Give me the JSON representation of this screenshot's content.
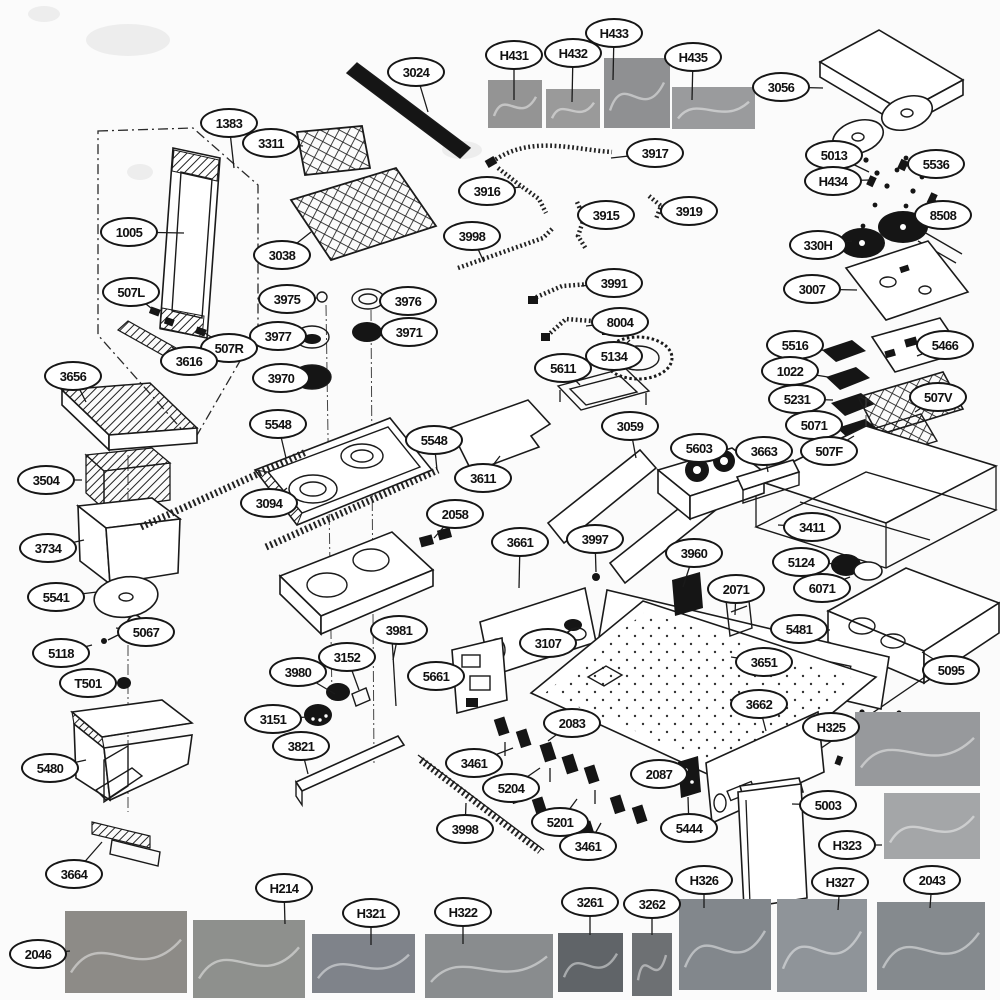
{
  "diagram": {
    "description": "Appliance exploded-parts diagram (gas range) with numbered callout labels and part photos",
    "ink_color": "#161616",
    "background_color": "#fbfbfb",
    "labels": [
      {
        "t": "3024",
        "x": 416,
        "y": 72,
        "tx": 428,
        "ty": 112
      },
      {
        "t": "H431",
        "x": 514,
        "y": 55,
        "tx": 514,
        "ty": 100
      },
      {
        "t": "H432",
        "x": 573,
        "y": 53,
        "tx": 572,
        "ty": 102
      },
      {
        "t": "H433",
        "x": 614,
        "y": 33,
        "tx": 613,
        "ty": 80
      },
      {
        "t": "H435",
        "x": 693,
        "y": 57,
        "tx": 692,
        "ty": 100
      },
      {
        "t": "3056",
        "x": 781,
        "y": 87,
        "tx": 823,
        "ty": 88
      },
      {
        "t": "1383",
        "x": 229,
        "y": 123,
        "tx": 234,
        "ty": 168
      },
      {
        "t": "3311",
        "x": 271,
        "y": 143,
        "tx": 303,
        "ty": 146
      },
      {
        "t": "3917",
        "x": 655,
        "y": 153,
        "tx": 611,
        "ty": 158
      },
      {
        "t": "5013",
        "x": 834,
        "y": 155,
        "tx": 869,
        "ty": 172
      },
      {
        "t": "H434",
        "x": 833,
        "y": 181,
        "tx": 870,
        "ty": 180
      },
      {
        "t": "5536",
        "x": 936,
        "y": 164,
        "tx": 906,
        "ty": 166
      },
      {
        "t": "3916",
        "x": 487,
        "y": 191,
        "tx": 521,
        "ty": 187
      },
      {
        "t": "3915",
        "x": 606,
        "y": 215,
        "tx": 580,
        "ty": 207
      },
      {
        "t": "3919",
        "x": 689,
        "y": 211,
        "tx": 661,
        "ty": 206
      },
      {
        "t": "8508",
        "x": 943,
        "y": 215,
        "tx": 933,
        "ty": 196
      },
      {
        "t": "1005",
        "x": 129,
        "y": 232,
        "tx": 184,
        "ty": 233
      },
      {
        "t": "3038",
        "x": 282,
        "y": 255,
        "tx": 311,
        "ty": 232
      },
      {
        "t": "3998",
        "x": 472,
        "y": 236,
        "tx": 484,
        "ty": 262
      },
      {
        "t": "330H",
        "x": 818,
        "y": 245,
        "tx": 852,
        "ty": 241
      },
      {
        "t": "3007",
        "x": 812,
        "y": 289,
        "tx": 857,
        "ty": 290
      },
      {
        "t": "3991",
        "x": 614,
        "y": 283,
        "tx": 581,
        "ty": 286
      },
      {
        "t": "507L",
        "x": 131,
        "y": 292,
        "tx": 156,
        "ty": 312
      },
      {
        "t": "3975",
        "x": 287,
        "y": 299,
        "tx": 317,
        "ty": 298
      },
      {
        "t": "3976",
        "x": 408,
        "y": 301,
        "tx": 384,
        "ty": 300
      },
      {
        "t": "8004",
        "x": 620,
        "y": 322,
        "tx": 586,
        "ty": 326
      },
      {
        "t": "3977",
        "x": 278,
        "y": 336,
        "tx": 300,
        "ty": 337
      },
      {
        "t": "3971",
        "x": 409,
        "y": 332,
        "tx": 382,
        "ty": 332
      },
      {
        "t": "507R",
        "x": 229,
        "y": 348,
        "tx": 203,
        "ty": 332
      },
      {
        "t": "3616",
        "x": 189,
        "y": 361,
        "tx": 172,
        "ty": 347
      },
      {
        "t": "5134",
        "x": 614,
        "y": 356,
        "tx": 630,
        "ty": 340
      },
      {
        "t": "5611",
        "x": 563,
        "y": 368,
        "tx": 580,
        "ty": 385
      },
      {
        "t": "5516",
        "x": 795,
        "y": 345,
        "tx": 827,
        "ty": 351
      },
      {
        "t": "5466",
        "x": 945,
        "y": 345,
        "tx": 917,
        "ty": 356
      },
      {
        "t": "3970",
        "x": 281,
        "y": 378,
        "tx": 296,
        "ty": 377
      },
      {
        "t": "1022",
        "x": 790,
        "y": 371,
        "tx": 828,
        "ty": 377
      },
      {
        "t": "3656",
        "x": 73,
        "y": 376,
        "tx": 86,
        "ty": 402
      },
      {
        "t": "5231",
        "x": 797,
        "y": 399,
        "tx": 833,
        "ty": 400
      },
      {
        "t": "507V",
        "x": 938,
        "y": 397,
        "tx": 915,
        "ty": 412
      },
      {
        "t": "5548",
        "x": 278,
        "y": 424,
        "tx": 286,
        "ty": 458
      },
      {
        "t": "5071",
        "x": 814,
        "y": 425,
        "tx": 840,
        "ty": 420
      },
      {
        "t": "5548",
        "x": 434,
        "y": 440,
        "tx": 437,
        "ty": 470
      },
      {
        "t": "3059",
        "x": 630,
        "y": 426,
        "tx": 636,
        "ty": 458
      },
      {
        "t": "507F",
        "x": 829,
        "y": 451,
        "tx": 854,
        "ty": 436
      },
      {
        "t": "3611",
        "x": 483,
        "y": 478,
        "tx": 500,
        "ty": 456
      },
      {
        "t": "5603",
        "x": 699,
        "y": 448,
        "tx": 708,
        "ty": 470
      },
      {
        "t": "3663",
        "x": 764,
        "y": 451,
        "tx": 768,
        "ty": 472
      },
      {
        "t": "3504",
        "x": 46,
        "y": 480,
        "tx": 82,
        "ty": 480
      },
      {
        "t": "3094",
        "x": 269,
        "y": 503,
        "tx": 287,
        "ty": 488
      },
      {
        "t": "3411",
        "x": 812,
        "y": 527,
        "tx": 778,
        "ty": 525
      },
      {
        "t": "3734",
        "x": 48,
        "y": 548,
        "tx": 84,
        "ty": 540
      },
      {
        "t": "2058",
        "x": 455,
        "y": 514,
        "tx": 434,
        "ty": 538
      },
      {
        "t": "3661",
        "x": 520,
        "y": 542,
        "tx": 519,
        "ty": 588
      },
      {
        "t": "3997",
        "x": 595,
        "y": 539,
        "tx": 596,
        "ty": 572
      },
      {
        "t": "3960",
        "x": 694,
        "y": 553,
        "tx": 683,
        "ty": 587
      },
      {
        "t": "5124",
        "x": 801,
        "y": 562,
        "tx": 838,
        "ty": 564
      },
      {
        "t": "2071",
        "x": 736,
        "y": 589,
        "tx": 735,
        "ty": 615
      },
      {
        "t": "6071",
        "x": 822,
        "y": 588,
        "tx": 850,
        "ty": 577
      },
      {
        "t": "5541",
        "x": 56,
        "y": 597,
        "tx": 97,
        "ty": 592
      },
      {
        "t": "5481",
        "x": 799,
        "y": 629,
        "tx": 830,
        "ty": 630
      },
      {
        "t": "5067",
        "x": 146,
        "y": 632,
        "tx": 116,
        "ty": 628
      },
      {
        "t": "3107",
        "x": 548,
        "y": 643,
        "tx": 573,
        "ty": 629
      },
      {
        "t": "5118",
        "x": 61,
        "y": 653,
        "tx": 92,
        "ty": 645
      },
      {
        "t": "3651",
        "x": 764,
        "y": 662,
        "tx": 731,
        "ty": 657
      },
      {
        "t": "5095",
        "x": 951,
        "y": 670,
        "tx": 922,
        "ty": 652
      },
      {
        "t": "T501",
        "x": 88,
        "y": 683,
        "tx": 120,
        "ty": 683
      },
      {
        "t": "3981",
        "x": 399,
        "y": 630,
        "tx": 393,
        "ty": 660
      },
      {
        "t": "3152",
        "x": 347,
        "y": 657,
        "tx": 359,
        "ty": 690
      },
      {
        "t": "3980",
        "x": 298,
        "y": 672,
        "tx": 335,
        "ty": 694
      },
      {
        "t": "5661",
        "x": 436,
        "y": 676,
        "tx": 461,
        "ty": 679
      },
      {
        "t": "2083",
        "x": 572,
        "y": 723,
        "tx": 548,
        "ty": 741
      },
      {
        "t": "3151",
        "x": 273,
        "y": 719,
        "tx": 308,
        "ty": 717
      },
      {
        "t": "3662",
        "x": 759,
        "y": 704,
        "tx": 766,
        "ty": 731
      },
      {
        "t": "H325",
        "x": 831,
        "y": 727,
        "tx": 860,
        "ty": 727
      },
      {
        "t": "3821",
        "x": 301,
        "y": 746,
        "tx": 308,
        "ty": 774
      },
      {
        "t": "5480",
        "x": 50,
        "y": 768,
        "tx": 86,
        "ty": 760
      },
      {
        "t": "3461",
        "x": 474,
        "y": 763,
        "tx": 513,
        "ty": 748
      },
      {
        "t": "5204",
        "x": 511,
        "y": 788,
        "tx": 540,
        "ty": 768
      },
      {
        "t": "2087",
        "x": 659,
        "y": 774,
        "tx": 680,
        "ty": 776
      },
      {
        "t": "5444",
        "x": 689,
        "y": 828,
        "tx": 688,
        "ty": 797
      },
      {
        "t": "5003",
        "x": 828,
        "y": 805,
        "tx": 792,
        "ty": 804
      },
      {
        "t": "3998",
        "x": 465,
        "y": 829,
        "tx": 466,
        "ty": 803
      },
      {
        "t": "5201",
        "x": 560,
        "y": 822,
        "tx": 577,
        "ty": 799
      },
      {
        "t": "3461",
        "x": 588,
        "y": 846,
        "tx": 601,
        "ty": 823
      },
      {
        "t": "H323",
        "x": 847,
        "y": 845,
        "tx": 882,
        "ty": 845
      },
      {
        "t": "3664",
        "x": 74,
        "y": 874,
        "tx": 102,
        "ty": 842
      },
      {
        "t": "H214",
        "x": 284,
        "y": 888,
        "tx": 285,
        "ty": 924
      },
      {
        "t": "H321",
        "x": 371,
        "y": 913,
        "tx": 371,
        "ty": 945
      },
      {
        "t": "H322",
        "x": 463,
        "y": 912,
        "tx": 463,
        "ty": 944
      },
      {
        "t": "3261",
        "x": 590,
        "y": 902,
        "tx": 590,
        "ty": 935
      },
      {
        "t": "3262",
        "x": 652,
        "y": 904,
        "tx": 652,
        "ty": 935
      },
      {
        "t": "H326",
        "x": 704,
        "y": 880,
        "tx": 704,
        "ty": 908
      },
      {
        "t": "H327",
        "x": 840,
        "y": 882,
        "tx": 838,
        "ty": 910
      },
      {
        "t": "2043",
        "x": 932,
        "y": 880,
        "tx": 930,
        "ty": 908
      },
      {
        "t": "2046",
        "x": 38,
        "y": 954,
        "tx": 70,
        "ty": 951
      }
    ],
    "photos": [
      {
        "id": "H431",
        "x": 488,
        "y": 80,
        "w": 54,
        "h": 48,
        "c": "#949494"
      },
      {
        "id": "H432",
        "x": 546,
        "y": 89,
        "w": 54,
        "h": 39,
        "c": "#9a9a9a"
      },
      {
        "id": "H433",
        "x": 604,
        "y": 58,
        "w": 66,
        "h": 70,
        "c": "#8f9092"
      },
      {
        "id": "H435",
        "x": 672,
        "y": 87,
        "w": 83,
        "h": 42,
        "c": "#9a9b9d"
      },
      {
        "id": "H325",
        "x": 855,
        "y": 712,
        "w": 125,
        "h": 74,
        "c": "#97999c"
      },
      {
        "id": "H323",
        "x": 884,
        "y": 793,
        "w": 96,
        "h": 66,
        "c": "#a4a6a8"
      },
      {
        "id": "2046",
        "x": 65,
        "y": 911,
        "w": 122,
        "h": 82,
        "c": "#8d8b87"
      },
      {
        "id": "H214",
        "x": 193,
        "y": 920,
        "w": 112,
        "h": 78,
        "c": "#8e908d"
      },
      {
        "id": "H321",
        "x": 312,
        "y": 934,
        "w": 103,
        "h": 59,
        "c": "#7f838a"
      },
      {
        "id": "H322",
        "x": 425,
        "y": 934,
        "w": 128,
        "h": 64,
        "c": "#898c8e"
      },
      {
        "id": "3261",
        "x": 558,
        "y": 933,
        "w": 65,
        "h": 59,
        "c": "#606468"
      },
      {
        "id": "3262",
        "x": 632,
        "y": 933,
        "w": 40,
        "h": 63,
        "c": "#6d7073"
      },
      {
        "id": "H326",
        "x": 679,
        "y": 899,
        "w": 92,
        "h": 91,
        "c": "#82878c"
      },
      {
        "id": "H327",
        "x": 777,
        "y": 899,
        "w": 90,
        "h": 93,
        "c": "#8f9499"
      },
      {
        "id": "2043",
        "x": 877,
        "y": 902,
        "w": 108,
        "h": 88,
        "c": "#858a8e"
      }
    ]
  }
}
